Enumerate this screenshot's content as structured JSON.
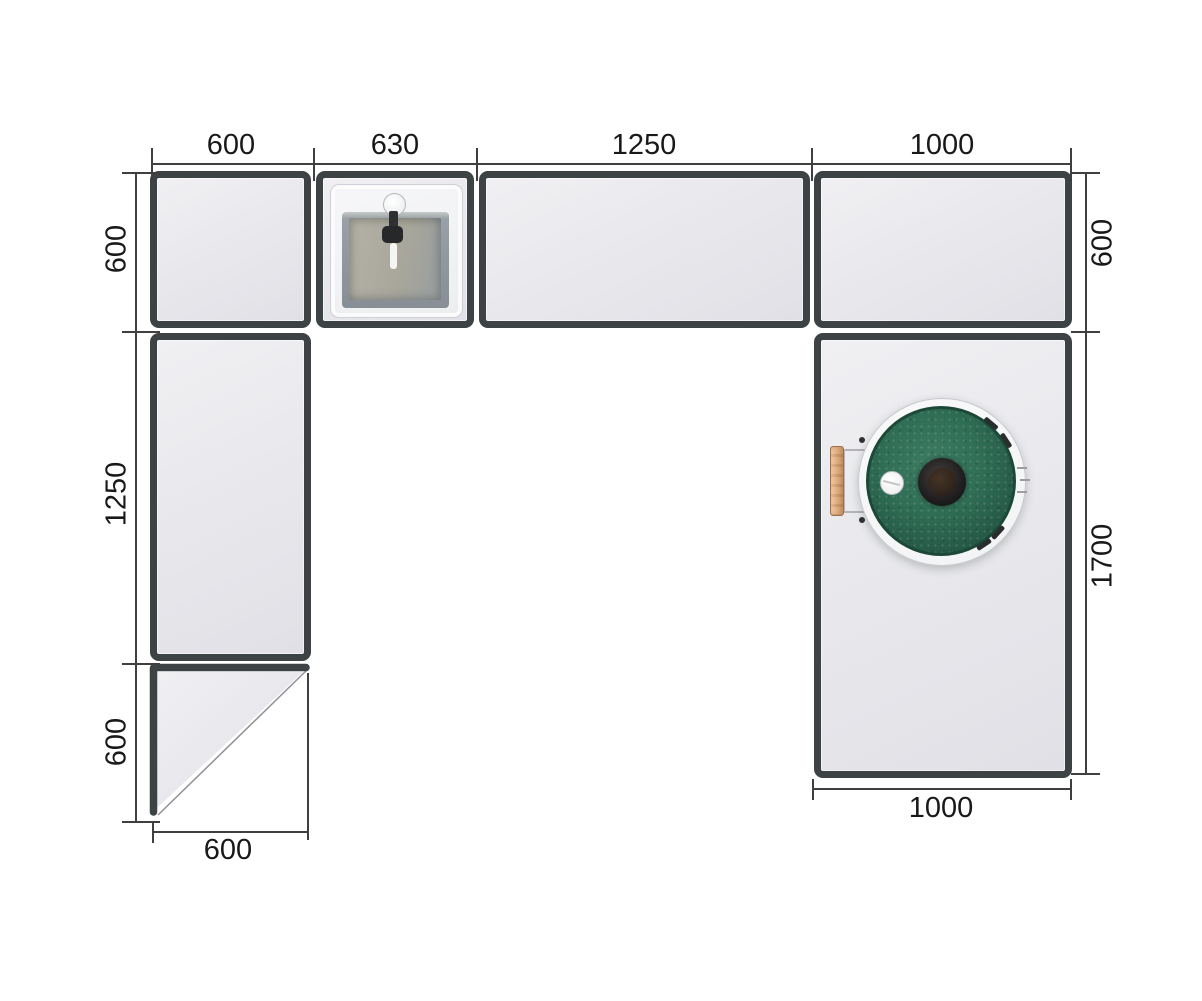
{
  "drawing": {
    "view": "top-view plan",
    "background": "#ffffff"
  },
  "dimensions": {
    "top": [
      "600",
      "630",
      "1250",
      "1000"
    ],
    "left": [
      "600",
      "1250",
      "600"
    ],
    "right": [
      "600",
      "1700"
    ],
    "bottom_left": "600",
    "bottom_right": "1000"
  },
  "modules": [
    {
      "id": "top-left-cabinet",
      "width": "600",
      "depth": "600"
    },
    {
      "id": "sink-cabinet",
      "width": "630",
      "depth": "600",
      "fixture": "sink"
    },
    {
      "id": "worktop-cabinet",
      "width": "1250",
      "depth": "600"
    },
    {
      "id": "top-right-cabinet",
      "width": "1000",
      "depth": "600"
    },
    {
      "id": "left-tall-cabinet",
      "width": "600",
      "depth": "1250"
    },
    {
      "id": "left-corner-end",
      "width": "600",
      "depth": "600",
      "shape": "diagonal-cut"
    },
    {
      "id": "grill-island",
      "width": "1000",
      "depth": "1700",
      "fixture": "kamado-grill"
    }
  ],
  "icons": {
    "sink": "square-sink-with-faucet-top-view",
    "grill": "green-kamado-grill-top-view",
    "grill_handle": "wooden-side-handle",
    "grill_vent_cap": "white-vent-cap",
    "grill_knob": "center-dark-knob"
  },
  "colors": {
    "module_border": "#3d4244",
    "module_fill": "#e9e9ee",
    "dimension_line": "#3f3f3f",
    "dimension_text": "#191919",
    "grill_green": "#2d6a53",
    "grill_knob_dark": "#17191a",
    "handle_wood": "#dcab7d",
    "sink_basin": "#a9a79b"
  }
}
